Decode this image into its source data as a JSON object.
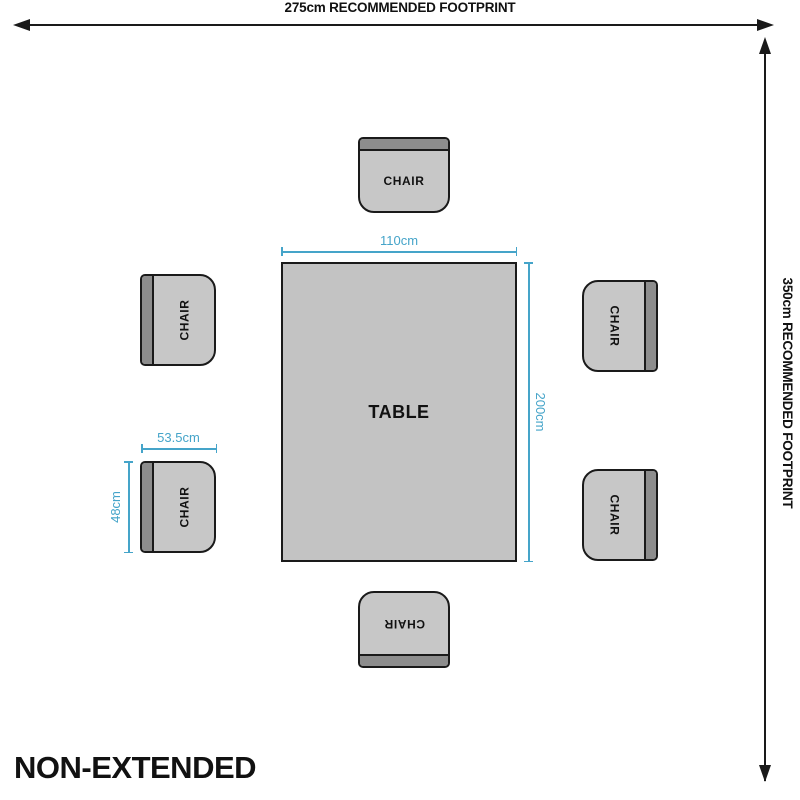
{
  "diagram": {
    "title": "NON-EXTENDED",
    "footprint": {
      "width_label": "275cm RECOMMENDED FOOTPRINT",
      "height_label": "350cm RECOMMENDED FOOTPRINT"
    },
    "table": {
      "label": "TABLE",
      "width_label": "110cm",
      "height_label": "200cm"
    },
    "chair": {
      "label": "CHAIR",
      "width_label": "53.5cm",
      "height_label": "48cm",
      "count": 6
    },
    "colors": {
      "dimension_blue": "#45a4c9",
      "chair_seat_gray": "#c7c7c7",
      "chair_back_gray": "#8d8d8d",
      "table_gray": "#c3c3c3",
      "outline_black": "#1a1a1a"
    }
  }
}
